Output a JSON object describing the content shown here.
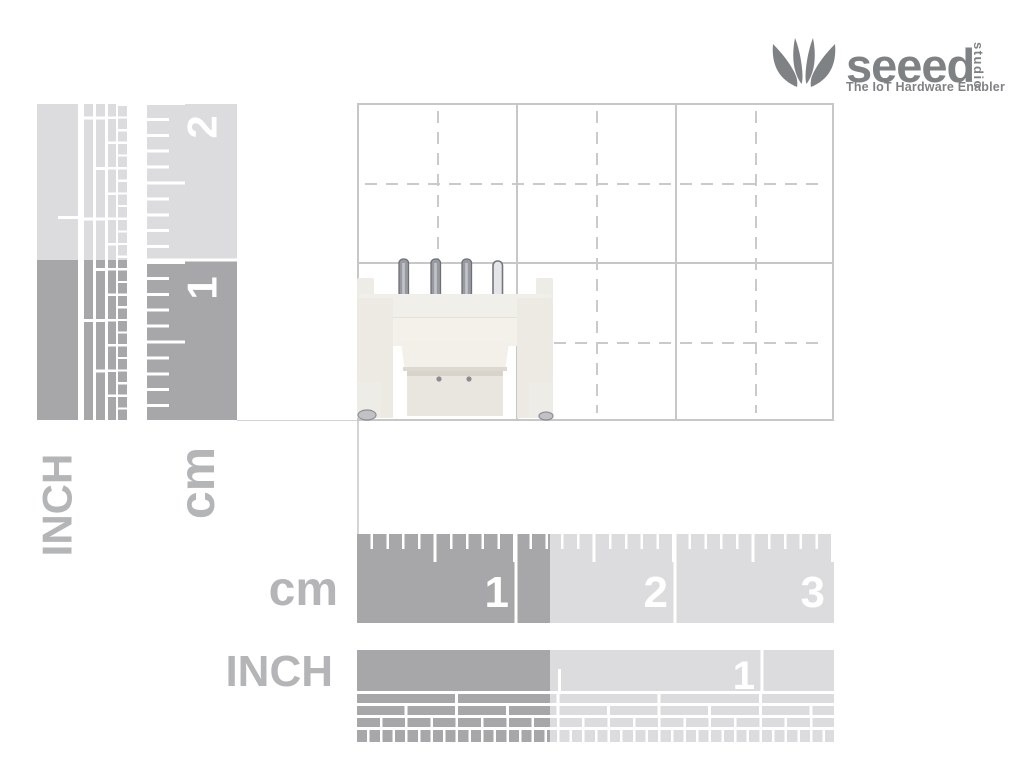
{
  "logo": {
    "brand": "seeed",
    "studio": "studio",
    "tagline": "The IoT Hardware Enabler",
    "leaf_icon": "lotus-leaf-mark",
    "color": "#7f8285"
  },
  "left_inch_ruler": {
    "label": "INCH"
  },
  "left_cm_ruler": {
    "label": "cm",
    "marks": [
      "2",
      "1"
    ]
  },
  "bottom_cm_ruler": {
    "label": "cm",
    "marks": [
      "1",
      "2",
      "3"
    ]
  },
  "bottom_inch_ruler": {
    "label": "INCH",
    "marks": [
      "1"
    ]
  },
  "product": {
    "description": "white 4-pin connector photographed against measurement grid"
  },
  "colors": {
    "ruler_light": "#dcdcde",
    "ruler_dark": "#a7a7a9",
    "label_gray": "#b4b5b7",
    "logo_gray": "#7f8285",
    "grid_line": "#c7c7c9",
    "grid_dash": "#cacacc",
    "tick_white": "#ffffff",
    "connector_body": "#f0eee8",
    "pin_gray": "#9b9da4"
  }
}
